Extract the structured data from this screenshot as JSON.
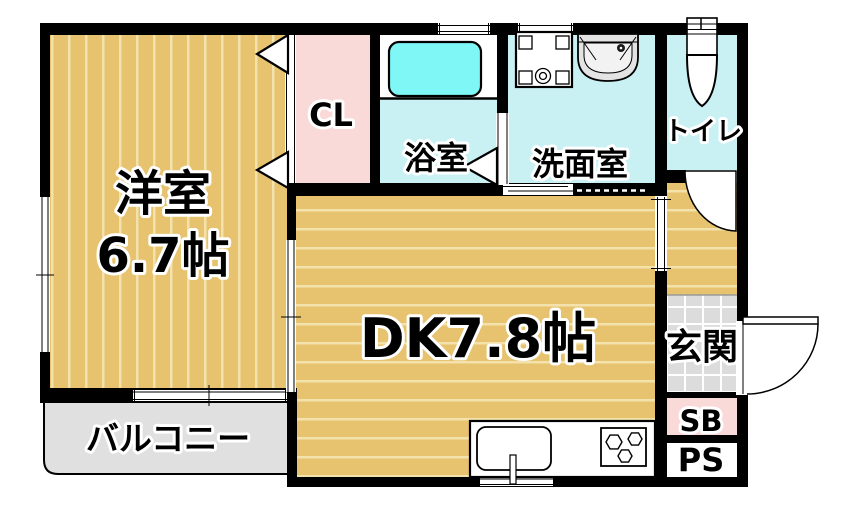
{
  "plan": {
    "type": "apartment-floorplan",
    "rooms": {
      "western_room": {
        "label": "洋室",
        "size": "6.7帖"
      },
      "closet": {
        "label": "CL"
      },
      "bathroom": {
        "label": "浴室"
      },
      "washroom": {
        "label": "洗面室"
      },
      "toilet": {
        "label": "トイレ"
      },
      "dining_kitchen": {
        "label": "DK7.8帖"
      },
      "entrance": {
        "label": "玄関"
      },
      "shoe_box": {
        "label": "SB"
      },
      "pipe_space": {
        "label": "PS"
      },
      "balcony": {
        "label": "バルコニー"
      }
    },
    "colors": {
      "wall": "#000000",
      "wood": "#E7C36F",
      "wood_stripe": "#F3E2AC",
      "pink": "#FAD9D9",
      "wet_room": "#C9F1F4",
      "bathtub": "#7FF7F7",
      "tile": "#DCDCDC",
      "tile_line": "#FFFFFF",
      "balcony": "#E0E0E0",
      "fixture_gray": "#E3E3E3"
    }
  }
}
